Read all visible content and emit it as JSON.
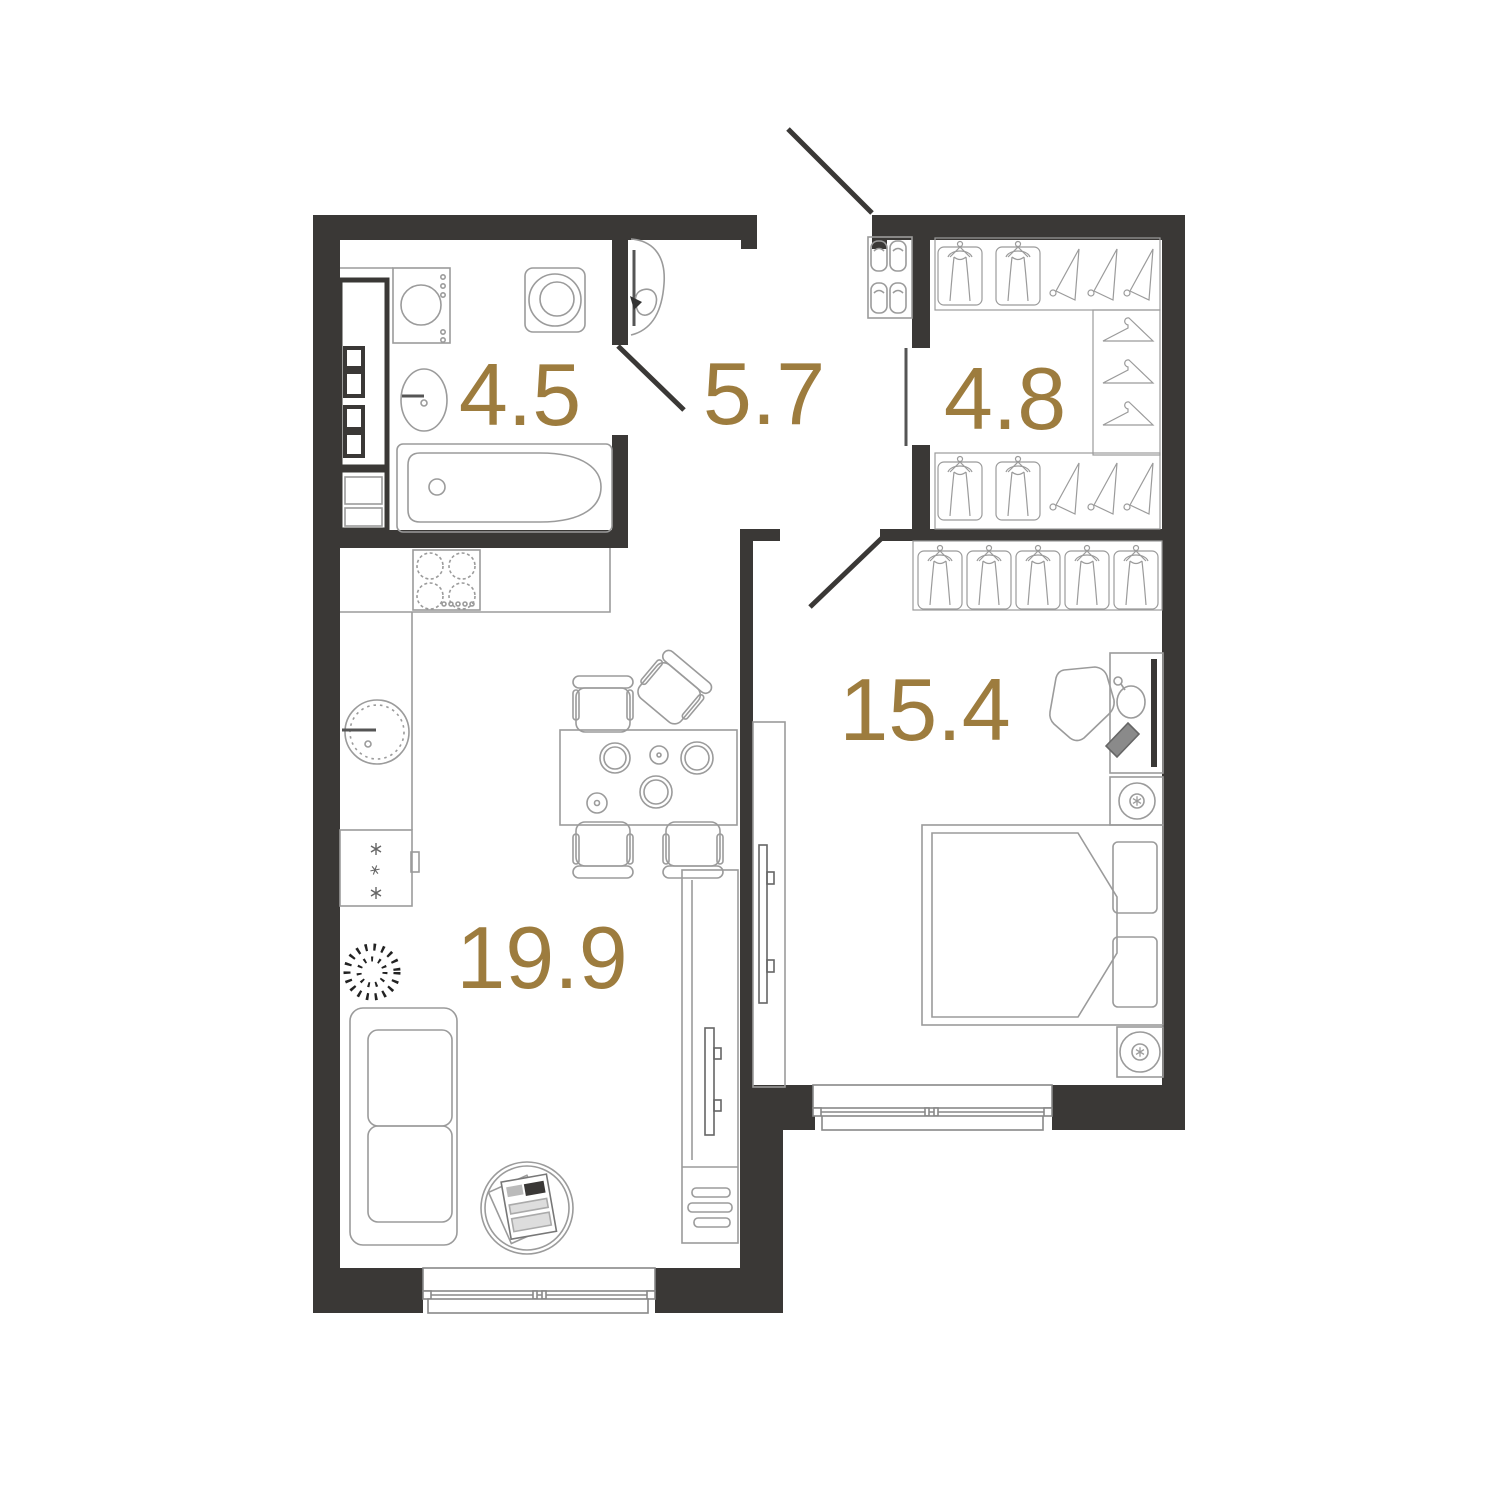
{
  "rooms": [
    {
      "name": "bathroom",
      "area": "4.5"
    },
    {
      "name": "hallway",
      "area": "5.7"
    },
    {
      "name": "wardrobe",
      "area": "4.8"
    },
    {
      "name": "bedroom",
      "area": "15.4"
    },
    {
      "name": "living-kitchen",
      "area": "19.9"
    }
  ],
  "colors": {
    "wall": "#3a3836",
    "label": "#9d7c3e",
    "line": "#9b9b9b",
    "dark_line": "#555555",
    "background": "#ffffff"
  }
}
